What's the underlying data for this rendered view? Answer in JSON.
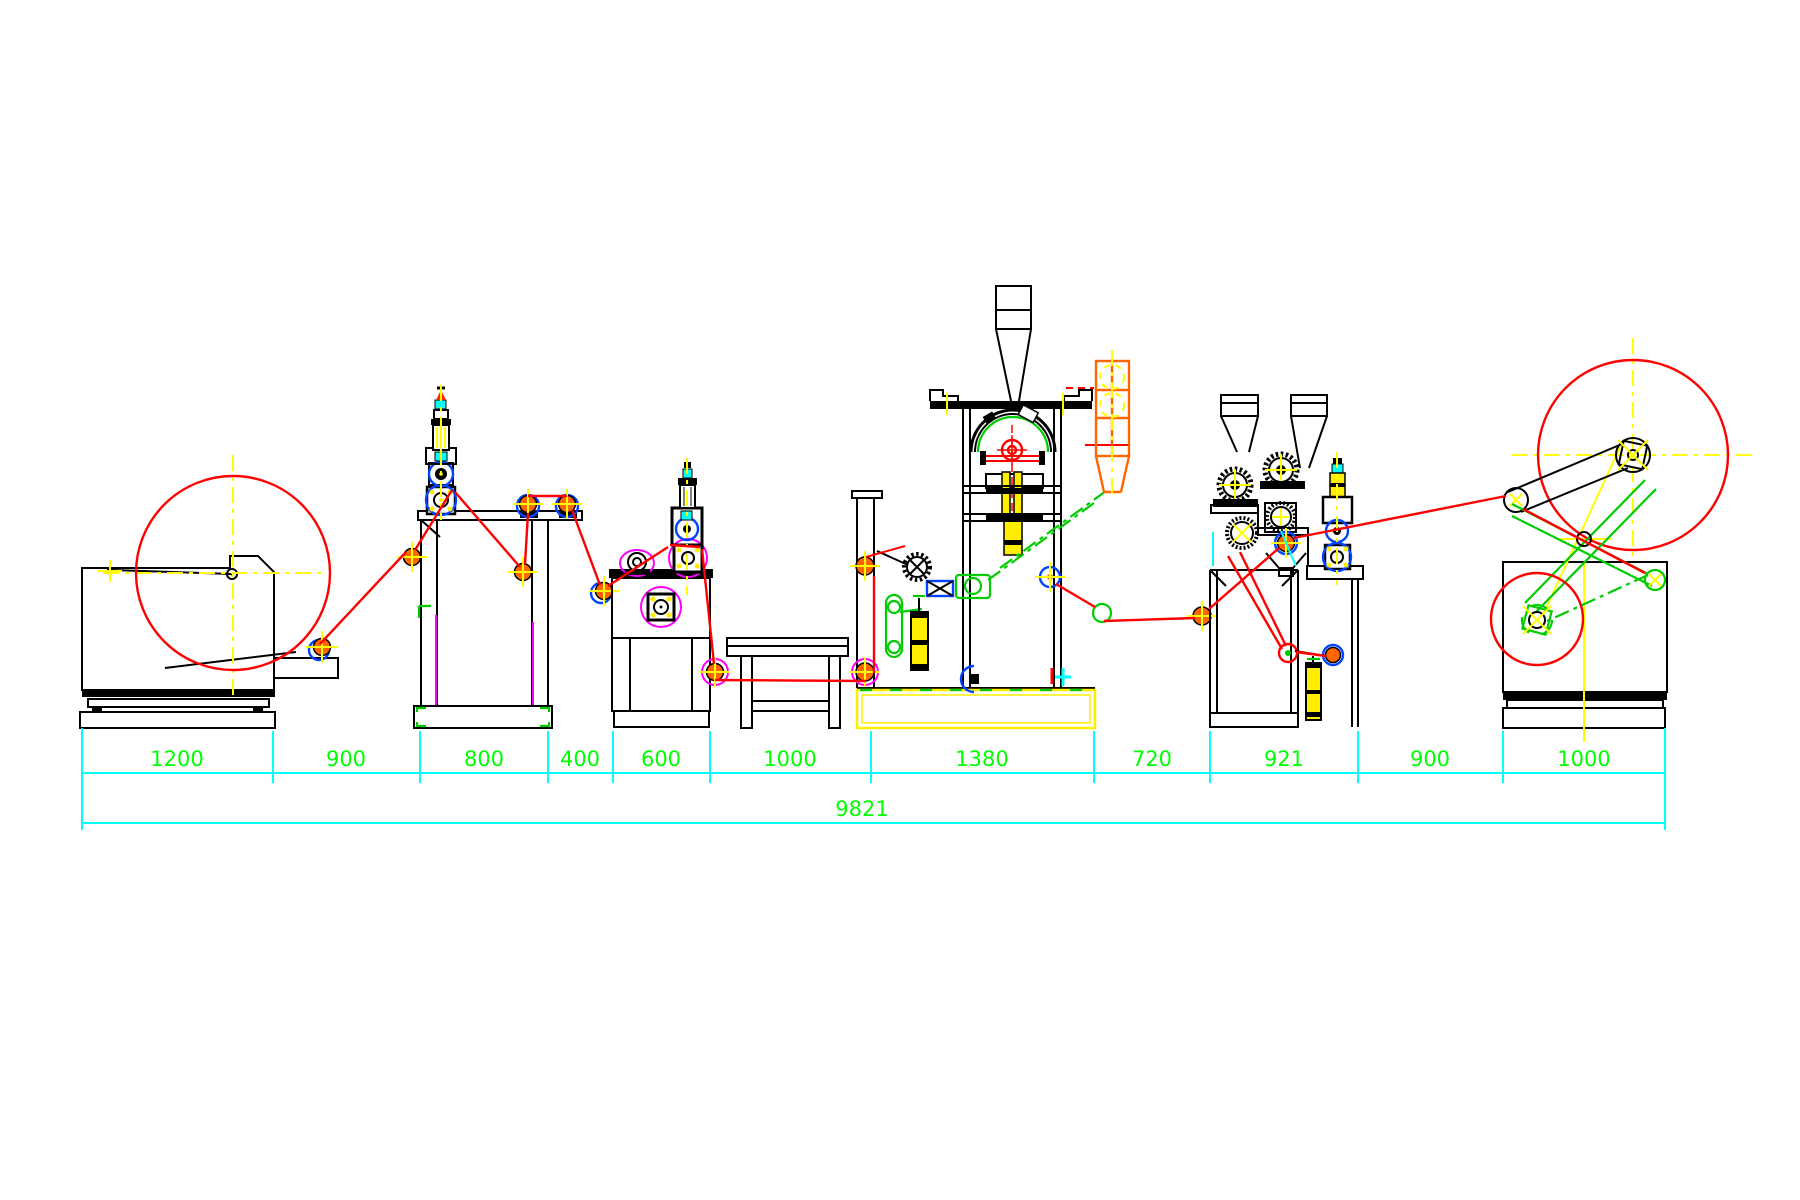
{
  "dimensions": {
    "row": [
      {
        "label": "1200"
      },
      {
        "label": "900"
      },
      {
        "label": "800"
      },
      {
        "label": "400"
      },
      {
        "label": "600"
      },
      {
        "label": "1000"
      },
      {
        "label": "1380"
      },
      {
        "label": "720"
      },
      {
        "label": "921"
      },
      {
        "label": "900"
      },
      {
        "label": "1000"
      }
    ],
    "total": {
      "label": "9821"
    }
  },
  "colors": {
    "background": "#ffffff",
    "outline": "#000000",
    "web_path_red": "#ff0000",
    "dimension_line_cyan": "#00ffff",
    "dimension_text_green": "#00ff00",
    "centerline_yellow": "#ffff00",
    "mechanism_green": "#00cc00",
    "detail_magenta": "#ff00ff",
    "bearing_blue": "#0044ff",
    "roller_orange": "#ff6600",
    "piston_yellow": "#ffee00"
  },
  "machines": [
    {
      "name": "unwinder"
    },
    {
      "name": "corona-treater-frame"
    },
    {
      "name": "coating-unit"
    },
    {
      "name": "support-table"
    },
    {
      "name": "bag-forming-unit"
    },
    {
      "name": "feeder-elevator"
    },
    {
      "name": "twin-extruder-laminator"
    },
    {
      "name": "corona-tower"
    },
    {
      "name": "winder"
    }
  ]
}
